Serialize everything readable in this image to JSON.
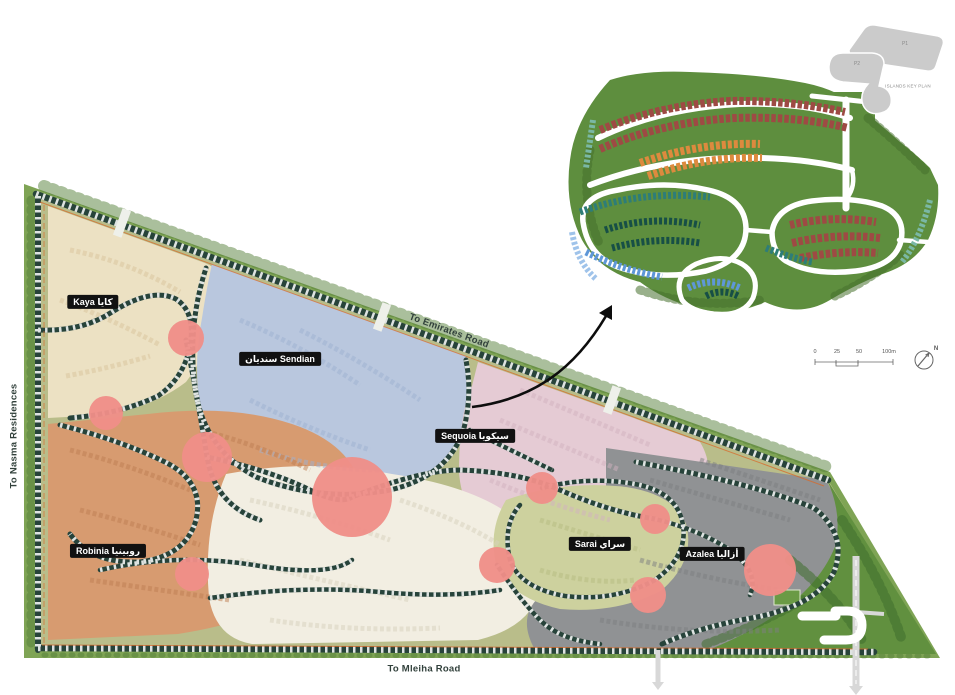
{
  "districts": {
    "kaya": {
      "label": "Kaya كايا"
    },
    "sendian": {
      "label": "سنديان  Sendian"
    },
    "sequoia": {
      "label": "Sequoia سيكويا"
    },
    "robinia": {
      "label": "Robinia روبينيا"
    },
    "sarai": {
      "label": "Sarai سراي"
    },
    "azalea": {
      "label": "Azalea أزاليا"
    }
  },
  "roads": {
    "emirates": "To Emirates Road",
    "mleiha": "To Mleiha Road",
    "nasma": "To Nasma Residences"
  },
  "inset": {
    "keyplan": {
      "p1": "P1",
      "p2": "P2",
      "caption": "ISLANDS KEY PLAN"
    },
    "scale": {
      "t0": "0",
      "t1": "25",
      "t2": "50",
      "t3": "100m"
    },
    "north_label": "N"
  },
  "markers": [
    {
      "x": 186,
      "y": 338,
      "r": 18
    },
    {
      "x": 106,
      "y": 413,
      "r": 17
    },
    {
      "x": 207,
      "y": 457,
      "r": 25
    },
    {
      "x": 352,
      "y": 497,
      "r": 40
    },
    {
      "x": 192,
      "y": 574,
      "r": 17
    },
    {
      "x": 542,
      "y": 488,
      "r": 16
    },
    {
      "x": 497,
      "y": 565,
      "r": 18
    },
    {
      "x": 655,
      "y": 519,
      "r": 15
    },
    {
      "x": 648,
      "y": 595,
      "r": 18
    },
    {
      "x": 770,
      "y": 570,
      "r": 26
    }
  ],
  "colors": {
    "marker": "#EF8F88",
    "kaya": "#ECE1C3",
    "sendian": "#B9C7DE",
    "sequoia": "#E5CBD4",
    "robinia": "#D79B70",
    "central": "#F2EEE2",
    "sarai": "#CDD19E",
    "azalea": "#909294",
    "park": "#61903F",
    "belt": "#7FA455",
    "olive": "#B9BD8A",
    "roadline": "#27433A",
    "accent_orange": "#D86A2A",
    "inset_green": "#5E8E3E"
  }
}
